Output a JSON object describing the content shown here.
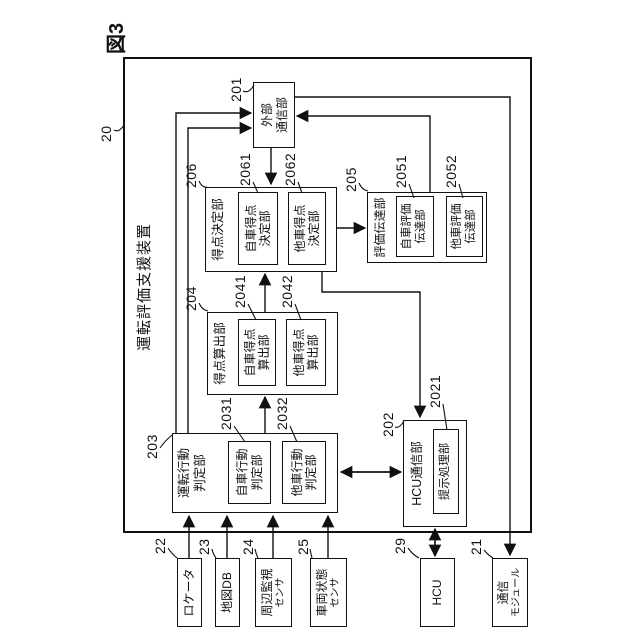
{
  "figure_label": "図3",
  "outer": {
    "ref": "20",
    "title": "運転評価支援装置"
  },
  "blocks": {
    "comm_ext": {
      "ref": "201",
      "line1": "外部",
      "line2": "通信部"
    },
    "behavior": {
      "ref": "203",
      "title1": "運転行動",
      "title2": "判定部",
      "own": {
        "ref": "2031",
        "line1": "自車行動",
        "line2": "判定部"
      },
      "other": {
        "ref": "2032",
        "line1": "他車行動",
        "line2": "判定部"
      }
    },
    "calc": {
      "ref": "204",
      "title": "得点算出部",
      "own": {
        "ref": "2041",
        "line1": "自車得点",
        "line2": "算出部"
      },
      "other": {
        "ref": "2042",
        "line1": "他車得点",
        "line2": "算出部"
      }
    },
    "decide": {
      "ref": "206",
      "title": "得点決定部",
      "own": {
        "ref": "2061",
        "line1": "自車得点",
        "line2": "決定部"
      },
      "other": {
        "ref": "2062",
        "line1": "他車得点",
        "line2": "決定部"
      }
    },
    "convey": {
      "ref": "205",
      "title": "評価伝達部",
      "own": {
        "ref": "2051",
        "line1": "自車評価",
        "line2": "伝達部"
      },
      "other": {
        "ref": "2052",
        "line1": "他車評価",
        "line2": "伝達部"
      }
    },
    "hcu_comm": {
      "ref": "202",
      "title": "HCU通信部",
      "present": {
        "ref": "2021",
        "title": "提示処理部"
      }
    }
  },
  "devices": {
    "locator": {
      "ref": "22",
      "line1": "ロケータ"
    },
    "map_db": {
      "ref": "23",
      "line1": "地図DB"
    },
    "perimeter": {
      "ref": "24",
      "line1": "周辺監視",
      "line2": "センサ"
    },
    "vehicle_state": {
      "ref": "25",
      "line1": "車両状態",
      "line2": "センサ"
    },
    "hcu": {
      "ref": "29",
      "line1": "HCU"
    },
    "comm_module": {
      "ref": "21",
      "line1": "通信",
      "line2": "モジュール"
    }
  },
  "colors": {
    "line": "#111111",
    "background": "#ffffff"
  }
}
